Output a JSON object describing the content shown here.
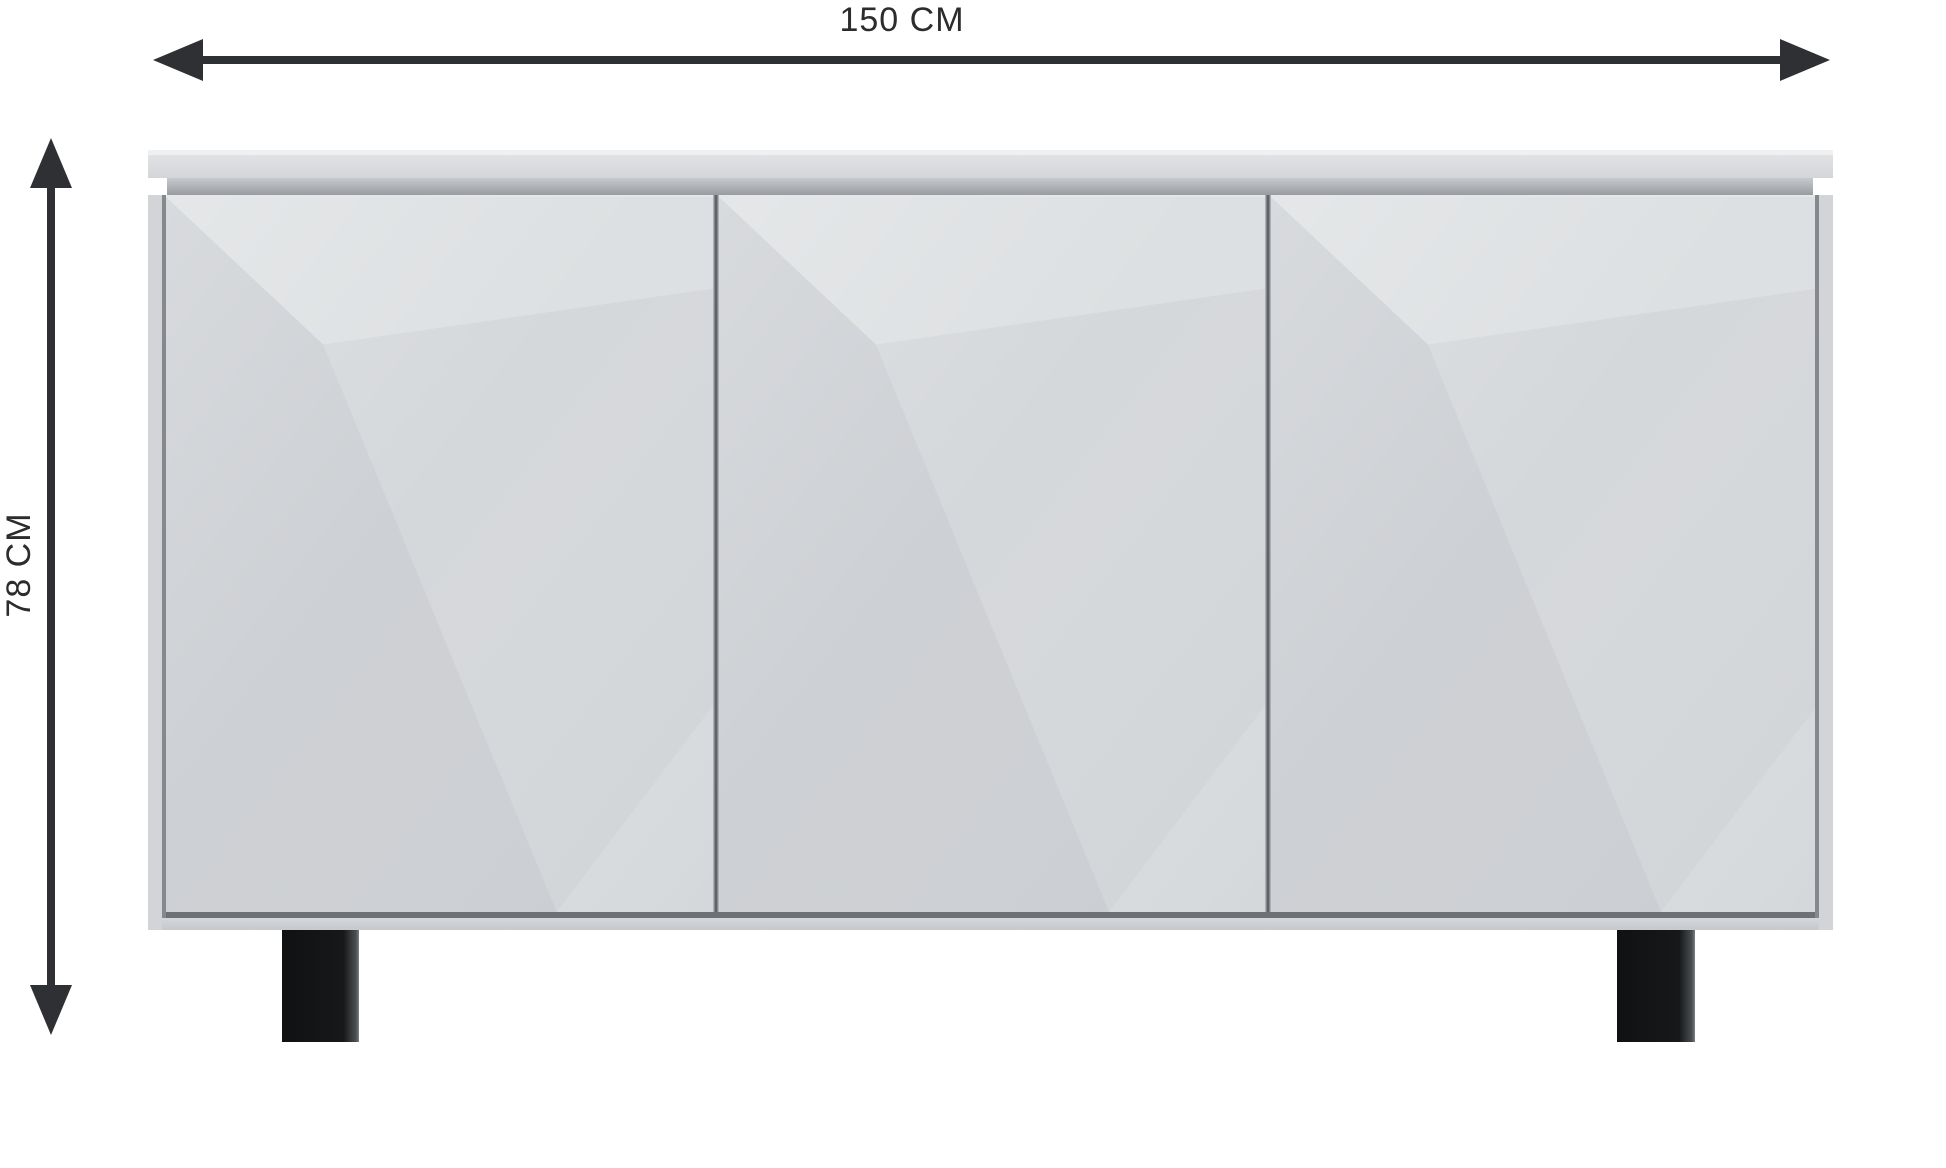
{
  "diagram": {
    "kind": "furniture-dimension-diagram",
    "subject": "three-door sideboard with faceted front panels and two black legs"
  },
  "dimensions": {
    "width": {
      "label": "150 CM",
      "orientation": "horizontal"
    },
    "height": {
      "label": "78 CM",
      "orientation": "vertical"
    }
  },
  "furniture": {
    "doors": [
      "left",
      "middle",
      "right"
    ],
    "legs": [
      "left",
      "right"
    ]
  },
  "colors": {
    "background": "#ffffff",
    "dim-line": "#2f3033",
    "label-text": "#2b2c2e",
    "slab-highlight": "#eef0f1",
    "slab-face-top": "#e0e2e4",
    "slab-face-bottom": "#d3d5d8",
    "recess-top": "#c7cacd",
    "recess-bottom": "#989ca0",
    "side-strip": "#d2d4d7",
    "edge-line": "#85898d",
    "divider": "#5d6165",
    "door-base": "#d2d5d8",
    "facet-top": "#dde0e2",
    "facet-left": "#cdd0d4",
    "facet-right": "#d5d8db",
    "facet-corner": "#dbdee0",
    "bottom-shadow-line": "#6d7175",
    "base-strip": "#d5d7da",
    "leg": "#17181a"
  }
}
